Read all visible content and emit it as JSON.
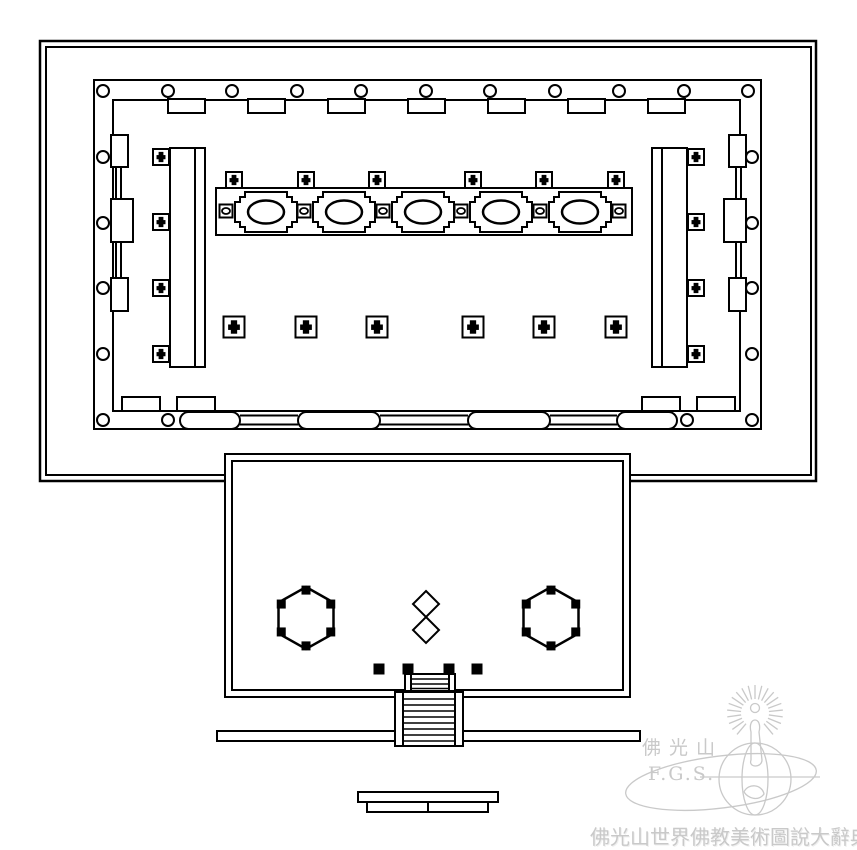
{
  "watermark": {
    "logo_cn": "佛光山",
    "logo_en": "F.G.S.",
    "caption": "佛光山世界佛教美術圖說大辭典"
  },
  "colors": {
    "ink": "#000000",
    "paper": "#ffffff",
    "watermark_gray": "#c9c9c9"
  },
  "plan": {
    "canvas": [
      857,
      850
    ],
    "enclosure": {
      "outer": [
        40,
        41,
        776,
        440
      ],
      "inner": [
        46,
        47,
        765,
        428
      ]
    },
    "hall": {
      "outer": [
        94,
        80,
        667,
        349
      ],
      "inner": [
        113,
        100,
        627,
        311
      ]
    },
    "columns": {
      "r": 6,
      "top": {
        "y": 91,
        "xs": [
          103,
          168,
          232,
          297,
          361,
          426,
          490,
          555,
          619,
          684,
          748
        ]
      },
      "bottom": {
        "y": 420,
        "xs": [
          103,
          168,
          687,
          752
        ]
      },
      "left": {
        "x": 103,
        "ys": [
          157,
          223,
          288,
          354
        ]
      },
      "right": {
        "x": 752,
        "ys": [
          157,
          223,
          288,
          354
        ]
      }
    },
    "top_openings": {
      "y": 99,
      "w": 37,
      "h": 14,
      "xs": [
        168,
        248,
        328,
        408,
        488,
        568,
        648
      ]
    },
    "bottom_openings": {
      "y": 397,
      "w": 38,
      "h": 14,
      "xs": [
        122,
        177,
        642,
        697
      ]
    },
    "door_capsules": {
      "y": 412,
      "h": 17,
      "spans": [
        [
          180,
          60
        ],
        [
          298,
          82
        ],
        [
          468,
          82
        ],
        [
          617,
          60
        ]
      ],
      "link_ys": [
        415.5,
        424.5
      ],
      "links": [
        [
          240,
          298
        ],
        [
          380,
          468
        ],
        [
          550,
          617
        ]
      ]
    },
    "wall_piers": {
      "left": [
        [
          111,
          135,
          17,
          32
        ],
        [
          111,
          199,
          22,
          43
        ],
        [
          111,
          278,
          17,
          33
        ]
      ],
      "left_links": [
        [
          116,
          167,
          5,
          32
        ],
        [
          116,
          242,
          5,
          36
        ]
      ],
      "right": [
        [
          729,
          135,
          17,
          32
        ],
        [
          724,
          199,
          22,
          43
        ],
        [
          729,
          278,
          17,
          33
        ]
      ],
      "right_links": [
        [
          736,
          167,
          5,
          32
        ],
        [
          736,
          242,
          5,
          36
        ]
      ]
    },
    "side_platforms": {
      "cross_size": 16,
      "cross_ys": [
        157,
        222,
        288,
        354
      ],
      "left": {
        "rect": [
          170,
          148,
          35,
          219
        ],
        "inner_x": 195,
        "cross_x": 161
      },
      "right": {
        "rect": [
          652,
          148,
          35,
          219
        ],
        "inner_x": 662,
        "cross_x": 696
      }
    },
    "altar": {
      "band": [
        216,
        188,
        416,
        47
      ],
      "pedestal_w": 62,
      "pedestal_h": 40,
      "pedestal_y": 192,
      "pedestal_xs": [
        235,
        313,
        392,
        470,
        549
      ],
      "mini_size": 13,
      "mini_cy": 211,
      "mini_xs": [
        226,
        304,
        383,
        461,
        540,
        619
      ],
      "cross_size": 16,
      "cross_cy": 180,
      "cross_xs": [
        234,
        306,
        377,
        473,
        544,
        616
      ]
    },
    "hall_pillars": {
      "cross_size": 21,
      "cy": 327,
      "xs": [
        234,
        306,
        377,
        473,
        544,
        616
      ]
    },
    "annex": {
      "outer": [
        225,
        454,
        405,
        243
      ],
      "inner": [
        232,
        461,
        391,
        229
      ]
    },
    "hexagons": {
      "rx": 27.5,
      "ry": 31,
      "dot": 9,
      "centers": [
        [
          306,
          618
        ],
        [
          551,
          618
        ]
      ]
    },
    "diamonds": {
      "r": 13,
      "centers": [
        [
          426,
          604
        ],
        [
          426,
          630
        ]
      ]
    },
    "entry_dots": {
      "size": 11,
      "cy": 669,
      "xs": [
        379,
        408,
        449,
        477
      ]
    },
    "upper_stair": {
      "rect": [
        405,
        674,
        50,
        17
      ],
      "rail_xs": [
        411,
        449
      ],
      "tread_ys": [
        679,
        684,
        688.5
      ]
    },
    "terrace_bar": [
      217,
      731,
      423,
      10
    ],
    "main_stair": {
      "rect": [
        395,
        692,
        68,
        54
      ],
      "rail_xs": [
        403,
        455
      ],
      "tread_ys": [
        699,
        705,
        711,
        717,
        723,
        729,
        735,
        741
      ]
    },
    "bottom_platform": {
      "top": [
        358,
        792,
        140,
        10
      ],
      "lower": [
        367,
        802,
        121,
        10
      ],
      "divider_x": 428
    }
  }
}
